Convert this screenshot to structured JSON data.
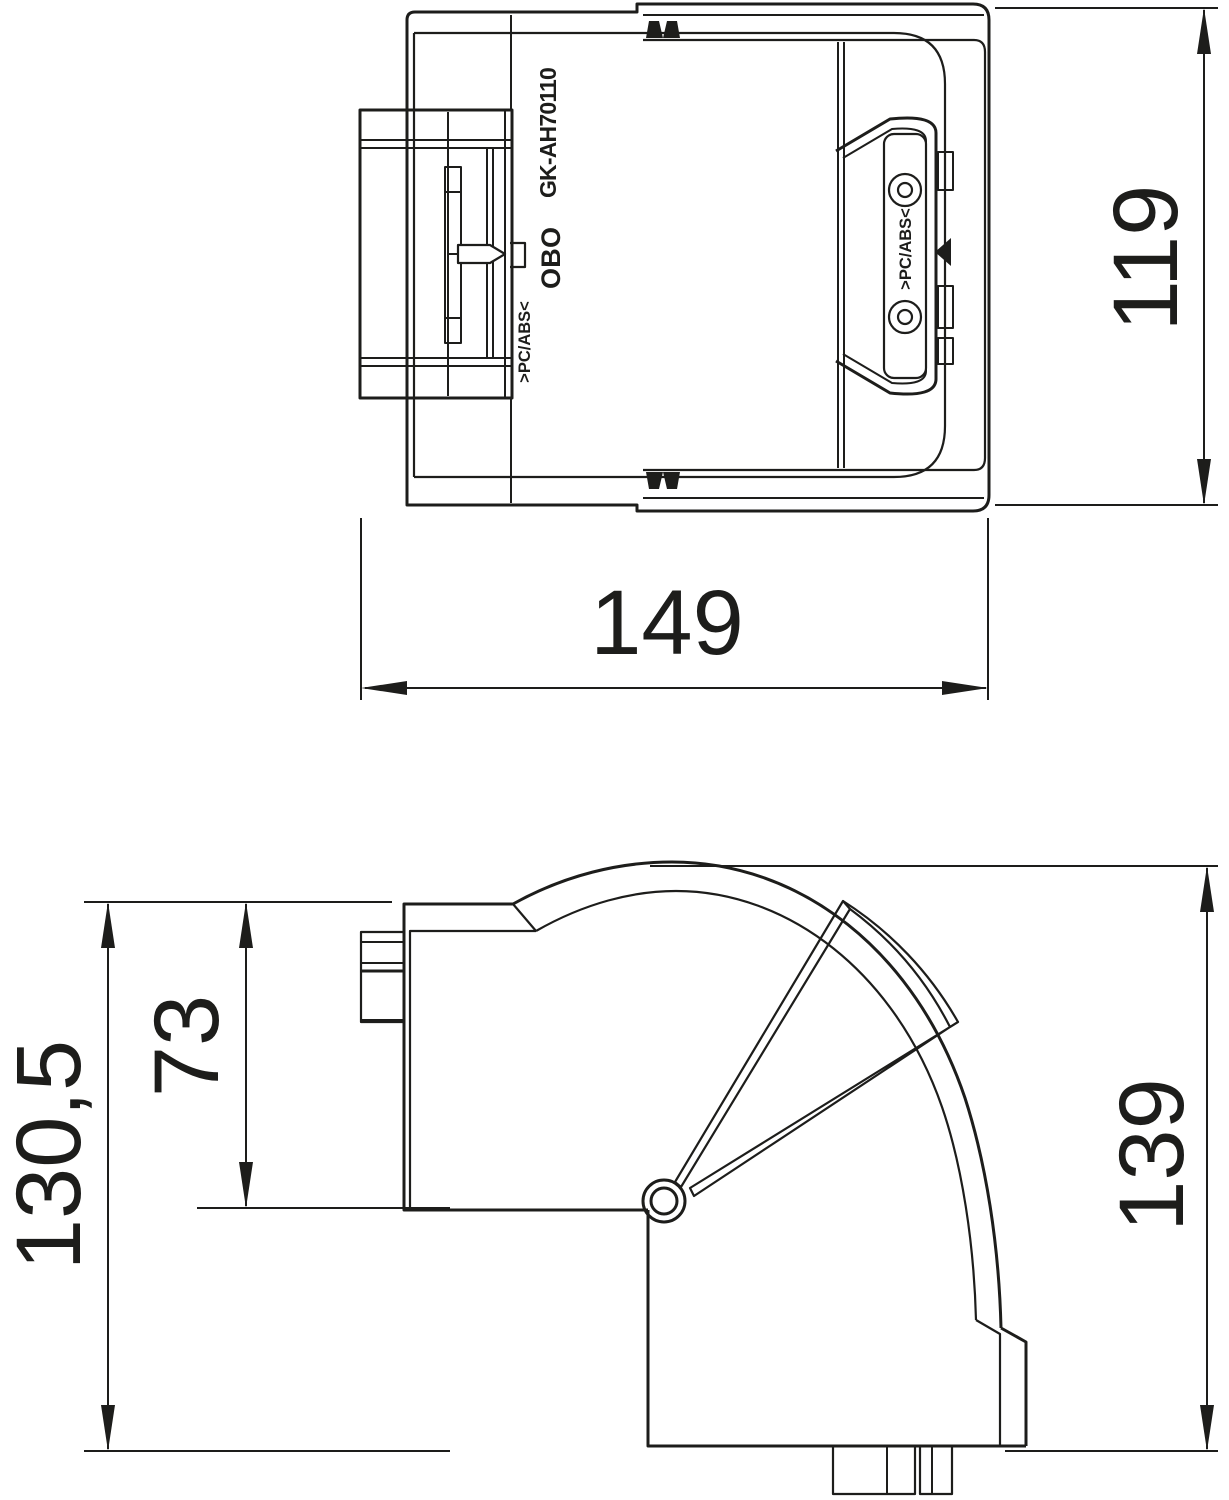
{
  "drawing": {
    "background": "#ffffff",
    "line_color": "#1d1d1b",
    "views": {
      "top": {
        "product_code": "GK-AH70110",
        "logo_text": "OBO",
        "material_marking_left": ">PC/ABS<",
        "material_marking_right": ">PC/ABS<",
        "dim_height": "119",
        "dim_width": "149"
      },
      "side": {
        "dim_total_height": "130,5",
        "dim_duct_height": "73",
        "dim_bend_height": "139"
      }
    }
  }
}
